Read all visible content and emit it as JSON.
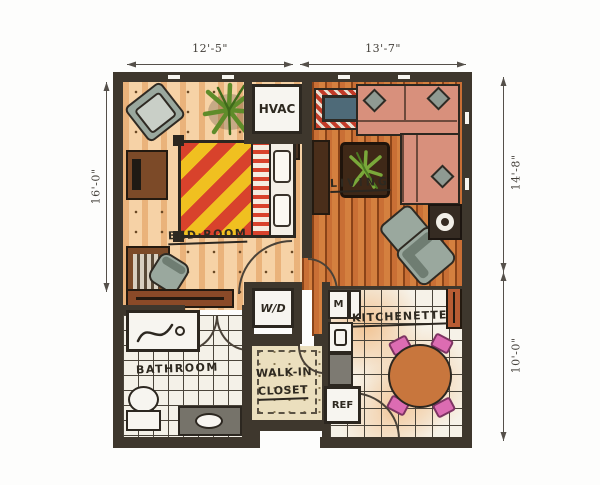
{
  "dimensions": {
    "top_left": "12'-5\"",
    "top_right": "13'-7\"",
    "left_side": "16'-0\"",
    "right_upper": "14'-8\"",
    "right_lower": "10'-0\""
  },
  "rooms": {
    "bedroom": "BED·ROOM",
    "living": "LIVING",
    "bathroom": "BATHROOM",
    "walk_in_line1": "WALK-IN",
    "walk_in_line2": "CLOSET",
    "kitchenette": "KITCHENETTE"
  },
  "fixtures": {
    "hvac": "HVAC",
    "washer_dryer": "W/D",
    "microwave": "M",
    "refrigerator": "REF"
  },
  "colors": {
    "wall": "#3e372d",
    "bedroom_floor": "#f6d2a6",
    "living_floor": "#c96f35",
    "bathroom_floor": "#f4f1e8",
    "closet_floor": "#ebdfbe",
    "kitchen_floor": "#f6f2e8",
    "sofa_salmon": "#d8907c",
    "bed_stripe_red": "#d8422c",
    "bed_stripe_yellow": "#f0c020",
    "chair_gray": "#9aa89e",
    "dining_chair_pink": "#dc6cb2",
    "table_wood": "#c8763d",
    "plant_green": "#6f9c33",
    "tv_accent_red": "#c23b28"
  }
}
